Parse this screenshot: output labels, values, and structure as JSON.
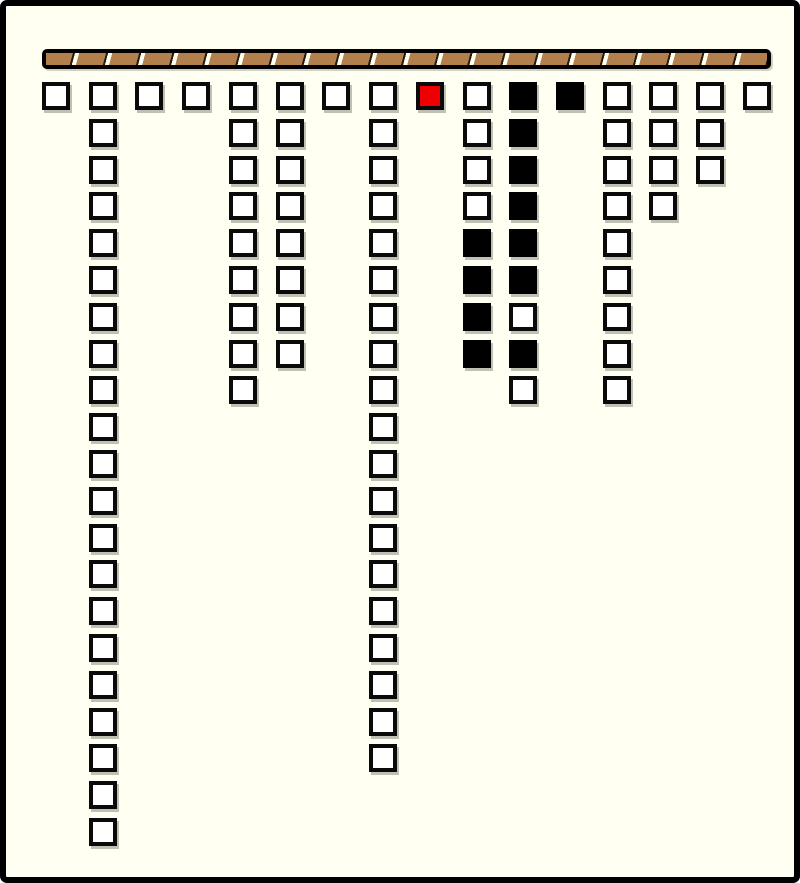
{
  "palette": {
    "background": "#fffff2",
    "frame_border": "#000000",
    "cell_border": "#0a0a0a",
    "cell_white": "#ffffff",
    "cell_black": "#000000",
    "cell_red": "#ee0000",
    "rope_black": "#000000",
    "rope_brown": "#b3804d",
    "rope_gap": "#fffff2",
    "shadow_gray": "#8d8d82"
  },
  "layout": {
    "canvas_width": 800,
    "canvas_height": 883,
    "frame_border_width": 6,
    "rope": {
      "x": 36,
      "y": 43,
      "width": 729,
      "height": 20,
      "segment_pitch": 33,
      "segment_count": 22
    },
    "grid": {
      "origin_x": 36,
      "origin_y": 76,
      "pitch_x": 46.73,
      "pitch_y": 36.8,
      "cell_size": 28,
      "columns_count": 16
    }
  },
  "board": {
    "cell_color_legend": {
      "white": "empty node",
      "black": "filled node",
      "red": "highlighted node"
    },
    "total_cells": 97,
    "columns": [
      [
        "white"
      ],
      [
        "white",
        "white",
        "white",
        "white",
        "white",
        "white",
        "white",
        "white",
        "white",
        "white",
        "white",
        "white",
        "white",
        "white",
        "white",
        "white",
        "white",
        "white",
        "white",
        "white",
        "white"
      ],
      [
        "white"
      ],
      [
        "white"
      ],
      [
        "white",
        "white",
        "white",
        "white",
        "white",
        "white",
        "white",
        "white",
        "white"
      ],
      [
        "white",
        "white",
        "white",
        "white",
        "white",
        "white",
        "white",
        "white"
      ],
      [
        "white"
      ],
      [
        "white",
        "white",
        "white",
        "white",
        "white",
        "white",
        "white",
        "white",
        "white",
        "white",
        "white",
        "white",
        "white",
        "white",
        "white",
        "white",
        "white",
        "white",
        "white"
      ],
      [
        "red"
      ],
      [
        "white",
        "white",
        "white",
        "white",
        "black",
        "black",
        "black",
        "black"
      ],
      [
        "black",
        "black",
        "black",
        "black",
        "black",
        "black",
        "white",
        "black",
        "white"
      ],
      [
        "black"
      ],
      [
        "white",
        "white",
        "white",
        "white",
        "white",
        "white",
        "white",
        "white",
        "white"
      ],
      [
        "white",
        "white",
        "white",
        "white"
      ],
      [
        "white",
        "white",
        "white"
      ],
      [
        "white"
      ]
    ]
  }
}
